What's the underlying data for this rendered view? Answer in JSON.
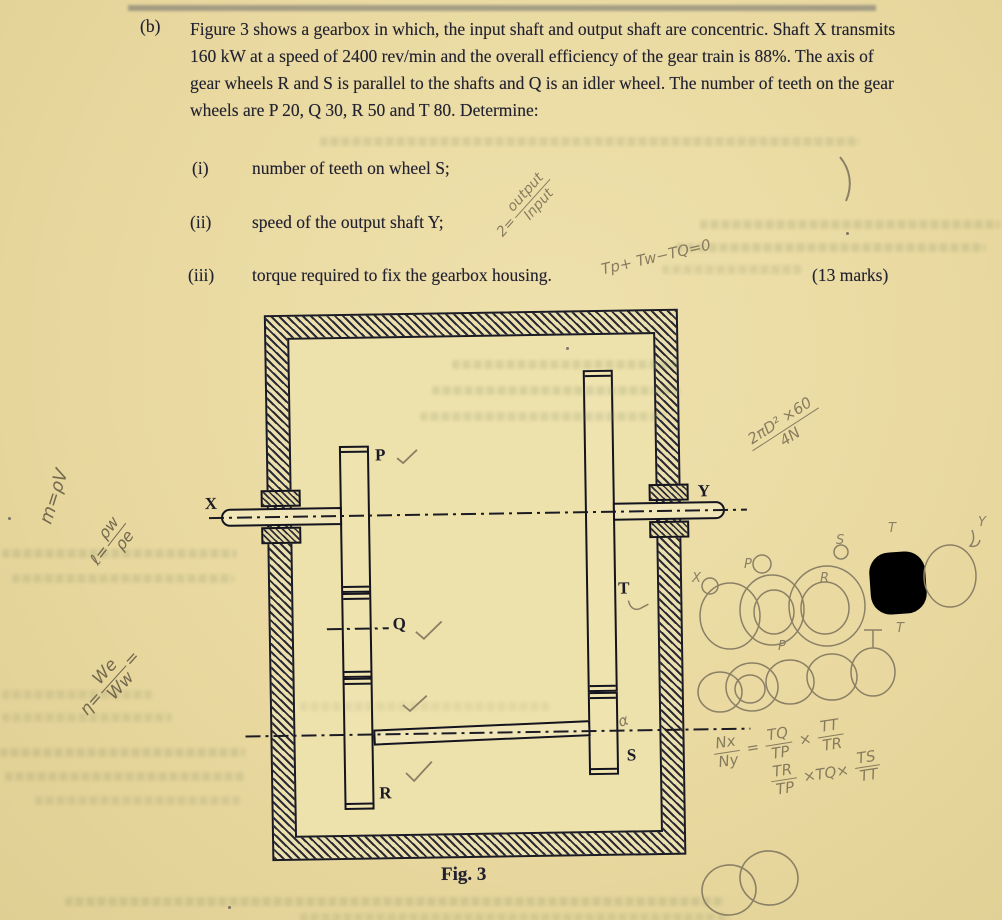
{
  "page": {
    "part_label": "(b)",
    "question": "Figure 3 shows a gearbox in which, the input shaft and output shaft are concentric. Shaft X transmits 160 kW at a speed of 2400 rev/min and the overall efficiency of the gear train is 88%. The axis of gear wheels R and S is parallel to the shafts and Q is an idler wheel. The number of teeth on the gear wheels are P 20,  Q 30,  R 50 and T 80. Determine:",
    "items": [
      {
        "label": "(i)",
        "text": "number of teeth on wheel S;"
      },
      {
        "label": "(ii)",
        "text": "speed of the output shaft Y;"
      },
      {
        "label": "(iii)",
        "text": "torque required to fix the gearbox housing."
      }
    ],
    "marks": "(13 marks)"
  },
  "figure": {
    "caption": "Fig. 3",
    "labels": {
      "x": "X",
      "y": "Y",
      "p": "P",
      "q": "Q",
      "r": "R",
      "s": "S",
      "t": "T"
    }
  },
  "annotations": {
    "eff_ratio": {
      "prefix": "2=",
      "num": "output",
      "den": "Input"
    },
    "torque_eq": "Tp+ Tw−TQ=0",
    "power_frac": {
      "num": "2πD² ×60",
      "den": "4N"
    },
    "speed_ratio": {
      "lhs": {
        "num": "Nx",
        "den": "Ny"
      },
      "eq": "=",
      "f1": {
        "num": "TQ",
        "den": "TP"
      },
      "x1": "×",
      "f2": {
        "num": "TT",
        "den": "TR"
      },
      "g1": {
        "num": "TR",
        "den": "TP"
      },
      "mid": "×TQ×",
      "g2": {
        "num": "TS",
        "den": "TT"
      }
    },
    "margin_mass": "m=ρV",
    "margin_density": {
      "prefix": "ℓ=",
      "num": "ρw",
      "den": "ρe"
    },
    "margin_eff": {
      "prefix": "η=",
      "num": "We",
      "den": "Ww",
      "suffix": "="
    },
    "alpha_mark": "α",
    "sketch_letters_row1": [
      "X",
      "P",
      "S",
      "R",
      "T",
      "Y"
    ],
    "sketch_letters_row2": [
      "P",
      "T"
    ]
  }
}
